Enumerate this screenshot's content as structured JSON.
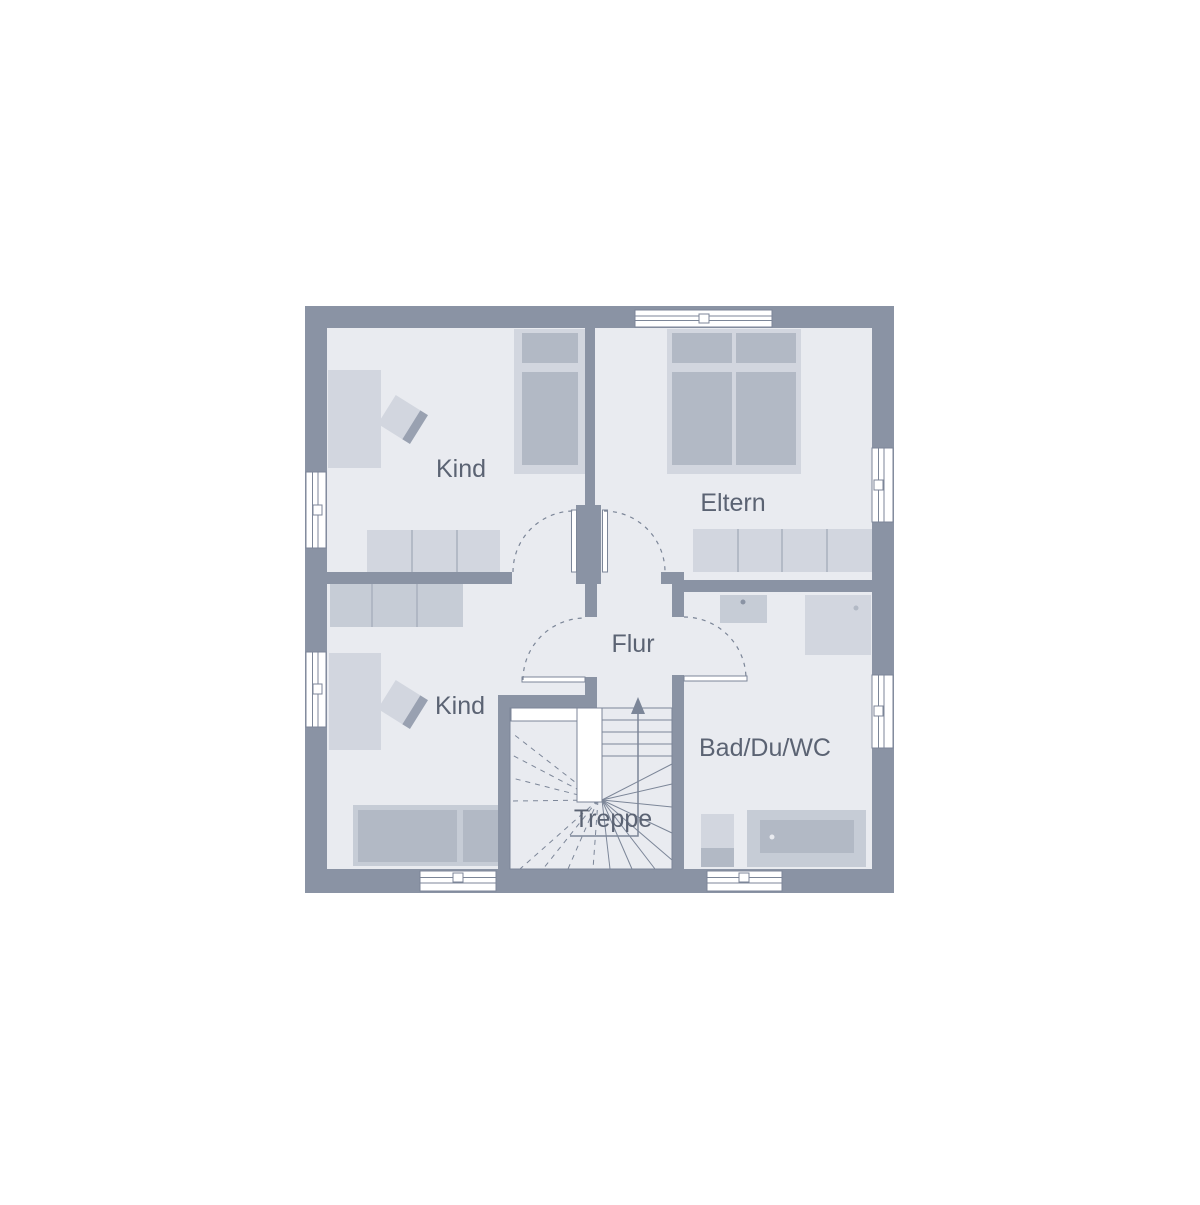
{
  "page": {
    "background": "#ffffff"
  },
  "colors": {
    "page_bg": "#ffffff",
    "wall": "#8a93a4",
    "floor": "#e9ebf0",
    "furniture_light": "#d2d6df",
    "furniture_mid": "#c6ccd6",
    "furniture_dark": "#b2b9c5",
    "chair_back": "#99a1b1",
    "divider": "#a9b0be",
    "line": "#7c8698",
    "text": "#5b6373",
    "door_leaf": "#ffffff"
  },
  "rooms": {
    "kind_top": {
      "label": "Kind"
    },
    "eltern": {
      "label": "Eltern"
    },
    "kind_bottom": {
      "label": "Kind"
    },
    "flur": {
      "label": "Flur"
    },
    "bad": {
      "label": "Bad/Du/WC"
    },
    "treppe": {
      "label": "Treppe"
    }
  }
}
